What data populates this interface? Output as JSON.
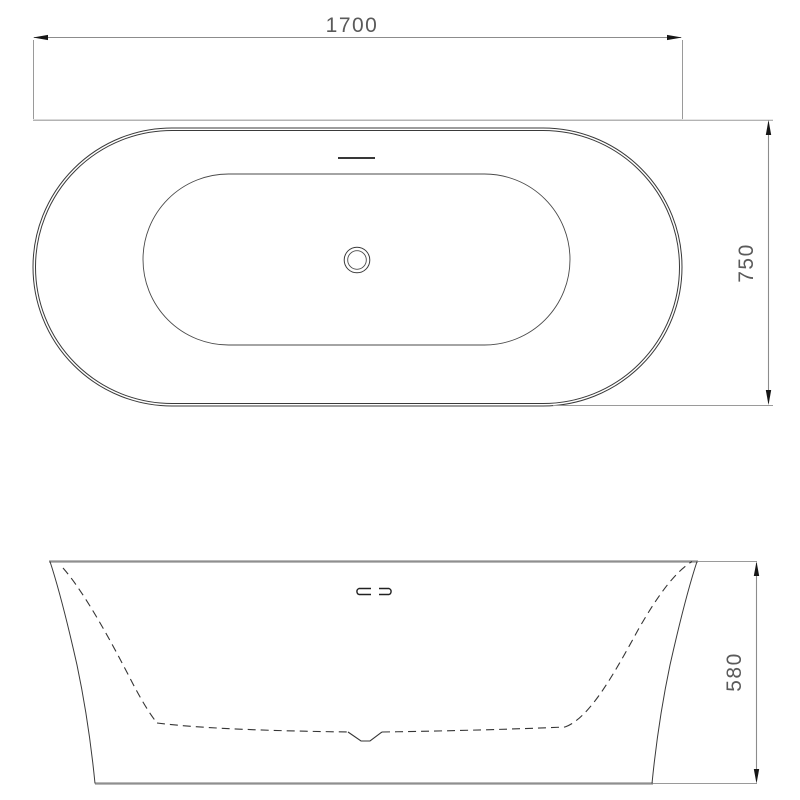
{
  "drawing": {
    "type": "bathtub-technical-drawing",
    "views": {
      "top_view": "plan view of oval freestanding bathtub",
      "front_view": "front elevation of bathtub"
    },
    "dimensions": {
      "width": "1700",
      "depth": "750",
      "height": "580"
    },
    "features": {
      "drain": "concentric circle drain mark at basin center",
      "overflow_plan": "short horizontal overflow mark near top rim",
      "overflow_front": "twin slot overflow marks on front elevation"
    }
  },
  "colors": {
    "background": "#ffffff",
    "line_dark": "#3a3a3a",
    "line_gray": "#9a9a9a",
    "dimension_text": "#5a5a5a",
    "arrow": "#161616"
  }
}
